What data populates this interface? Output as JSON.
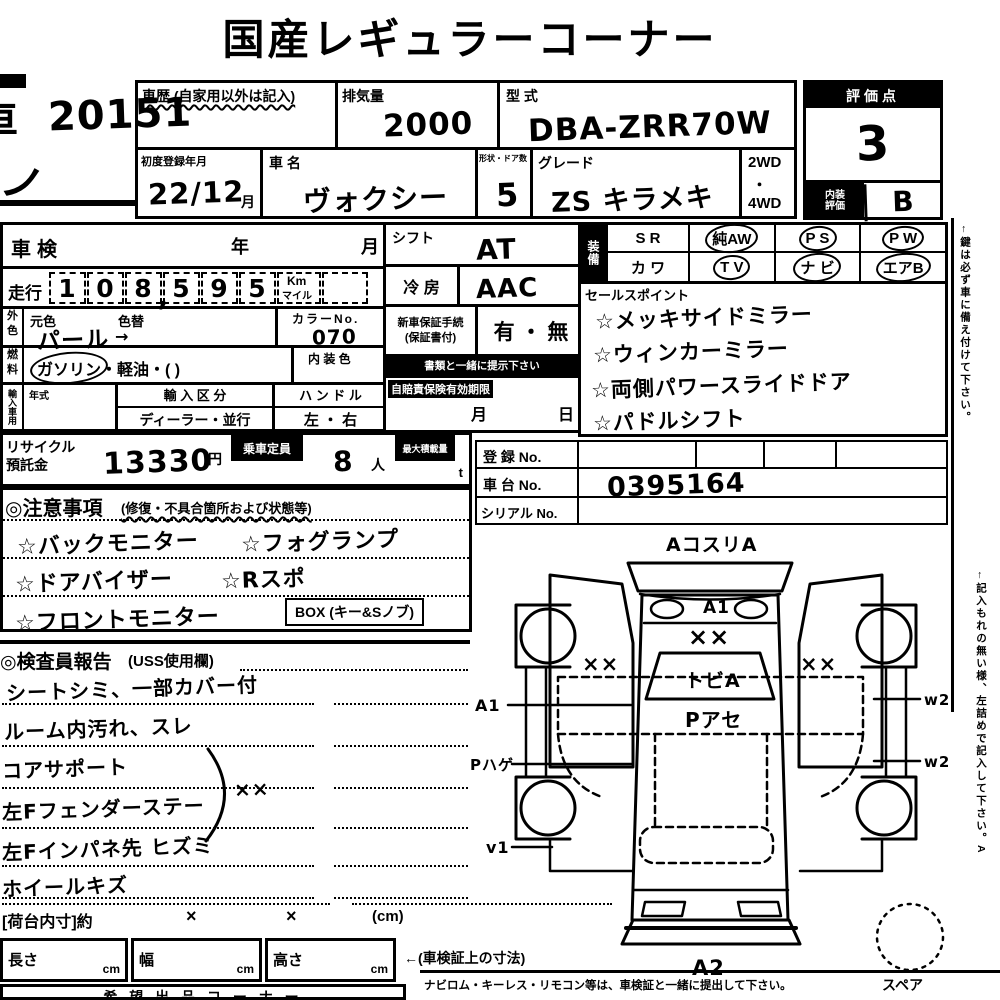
{
  "title": "国産レギュラーコーナー",
  "lot": {
    "corner_char": "車",
    "number": "20151",
    "scribble": "ノ"
  },
  "header": {
    "history_label": "車歴 (自家用以外は記入)",
    "displacement": {
      "label": "排気量",
      "value": "2000"
    },
    "model_code": {
      "label": "型 式",
      "value": "DBA-ZRR70W"
    },
    "first_reg": {
      "label": "初度登録年月",
      "value": "22/12",
      "unit": "月"
    },
    "car_name": {
      "label": "車  名",
      "value": "ヴォクシー"
    },
    "doors": {
      "label": "形状・ドア数",
      "value": "5"
    },
    "grade": {
      "label": "グレード",
      "value": "ZS キラメキ"
    },
    "drive": {
      "top": "2WD",
      "dot": "・",
      "bottom": "4WD"
    },
    "score": {
      "label": "評価点",
      "value": "3"
    },
    "interior": {
      "label1": "内装",
      "label2": "評価",
      "value": "B"
    }
  },
  "left": {
    "shaken": {
      "label": "車検",
      "year": "年",
      "month": "月"
    },
    "mileage": {
      "label": "走行",
      "d1": "1",
      "d2": "0",
      "d3": "8",
      "comma": ",",
      "d4": "5",
      "d5": "9",
      "d6": "5",
      "unit_top": "Km",
      "unit_bottom": "マイル"
    },
    "color": {
      "side1": "外",
      "side2": "色",
      "base_label": "元色",
      "change_label": "色替",
      "value": "パール",
      "arrow": "→",
      "no_label": "カラーNo.",
      "no_value": "070"
    },
    "fuel": {
      "side1": "燃",
      "side2": "料",
      "circled": "ガソリン",
      "rest": "・軽油・(        )",
      "interior_label": "内 装 色"
    },
    "import": {
      "side": "輸入車用",
      "year_label": "年式",
      "class_label": "輸 入 区 分",
      "class_value": "ディーラー・並行",
      "handle_label": "ハ ン ド ル",
      "handle_value": "左 ・ 右"
    },
    "recycle": {
      "label1": "リサイクル",
      "label2": "預託金",
      "value": "13330",
      "yen": "円",
      "cap_label": "乗車定員",
      "cap_value": "8",
      "cap_unit": "人",
      "load_label": "最大積載量",
      "load_unit": "t"
    }
  },
  "mid": {
    "shift": {
      "label": "シフト",
      "value": "AT"
    },
    "ac": {
      "label": "冷 房",
      "value": "AAC"
    },
    "warranty": {
      "label1": "新車保証手続",
      "label2": "(保証書付)",
      "options": "有 ・ 無"
    },
    "note": "書類と一緒に提示下さい",
    "insurance": {
      "label": "自賠責保険有効期限",
      "month": "月",
      "day": "日"
    }
  },
  "equipment": {
    "side": "装備",
    "r1c1": "S R",
    "r1c2": "純AW",
    "r1c3": "P S",
    "r1c4": "P W",
    "r2c1": "カ ワ",
    "r2c2": "T V",
    "r2c3": "ナ ビ",
    "r2c4": "エアB"
  },
  "sales": {
    "title": "セールスポイント",
    "items": [
      "☆メッキサイドミラー",
      "☆ウィンカーミラー",
      "☆両側パワースライドドア",
      "☆パドルシフト"
    ]
  },
  "reg": {
    "reg_label": "登 録 No.",
    "chassis_label": "車 台 No.",
    "chassis_value": "0395164",
    "serial_label": "シリアル No."
  },
  "notes": {
    "title": "◎注意事項",
    "subtitle": "(修復・不具合箇所および状態等)",
    "r1a": "☆バックモニター",
    "r1b": "☆フォグランプ",
    "r2a": "☆ドアバイザー",
    "r2b": "☆Rスポ",
    "r3a": "☆フロントモニター",
    "box": "BOX (キー&Sノブ)"
  },
  "report": {
    "title": "◎検査員報告",
    "subtitle": "(USS使用欄)",
    "lines": [
      "シートシミ、一部カバー付",
      "ルーム内汚れ、スレ",
      "コアサポート",
      "左Fフェンダーステー",
      "左Fインパネ先 ヒズミ",
      "ホイールキズ"
    ],
    "brace_mark": "××"
  },
  "diagram": {
    "top": "AコスリA",
    "hood": "A1",
    "hood_marks": "××",
    "windshield": "トビA",
    "cabin": "Pアセ",
    "left_marks": "××",
    "right_marks": "××",
    "l1": "A1",
    "l2": "Pハゲ",
    "l3": "v1",
    "r1": "w2",
    "r2": "w2",
    "rear": "A2",
    "spare": "スペア"
  },
  "bottom": {
    "bed_label": "[荷台内寸]約",
    "x1": "×",
    "x2": "×",
    "cm_note": "(cm)",
    "len_label": "長さ",
    "wid_label": "幅",
    "hgt_label": "高さ",
    "cm": "cm",
    "dims_note": "←(車検証上の寸法)",
    "corner_row": "希 望 出 品 コ ー ナ ー",
    "note": "ナビロム・キーレス・リモコン等は、車検証と一緒に提出して下さい。"
  },
  "side_notes": {
    "n1": "←鍵は必ず車に備え付けて下さい。",
    "n2": "←記入もれの無い様、左詰めで記入して下さい。A"
  }
}
